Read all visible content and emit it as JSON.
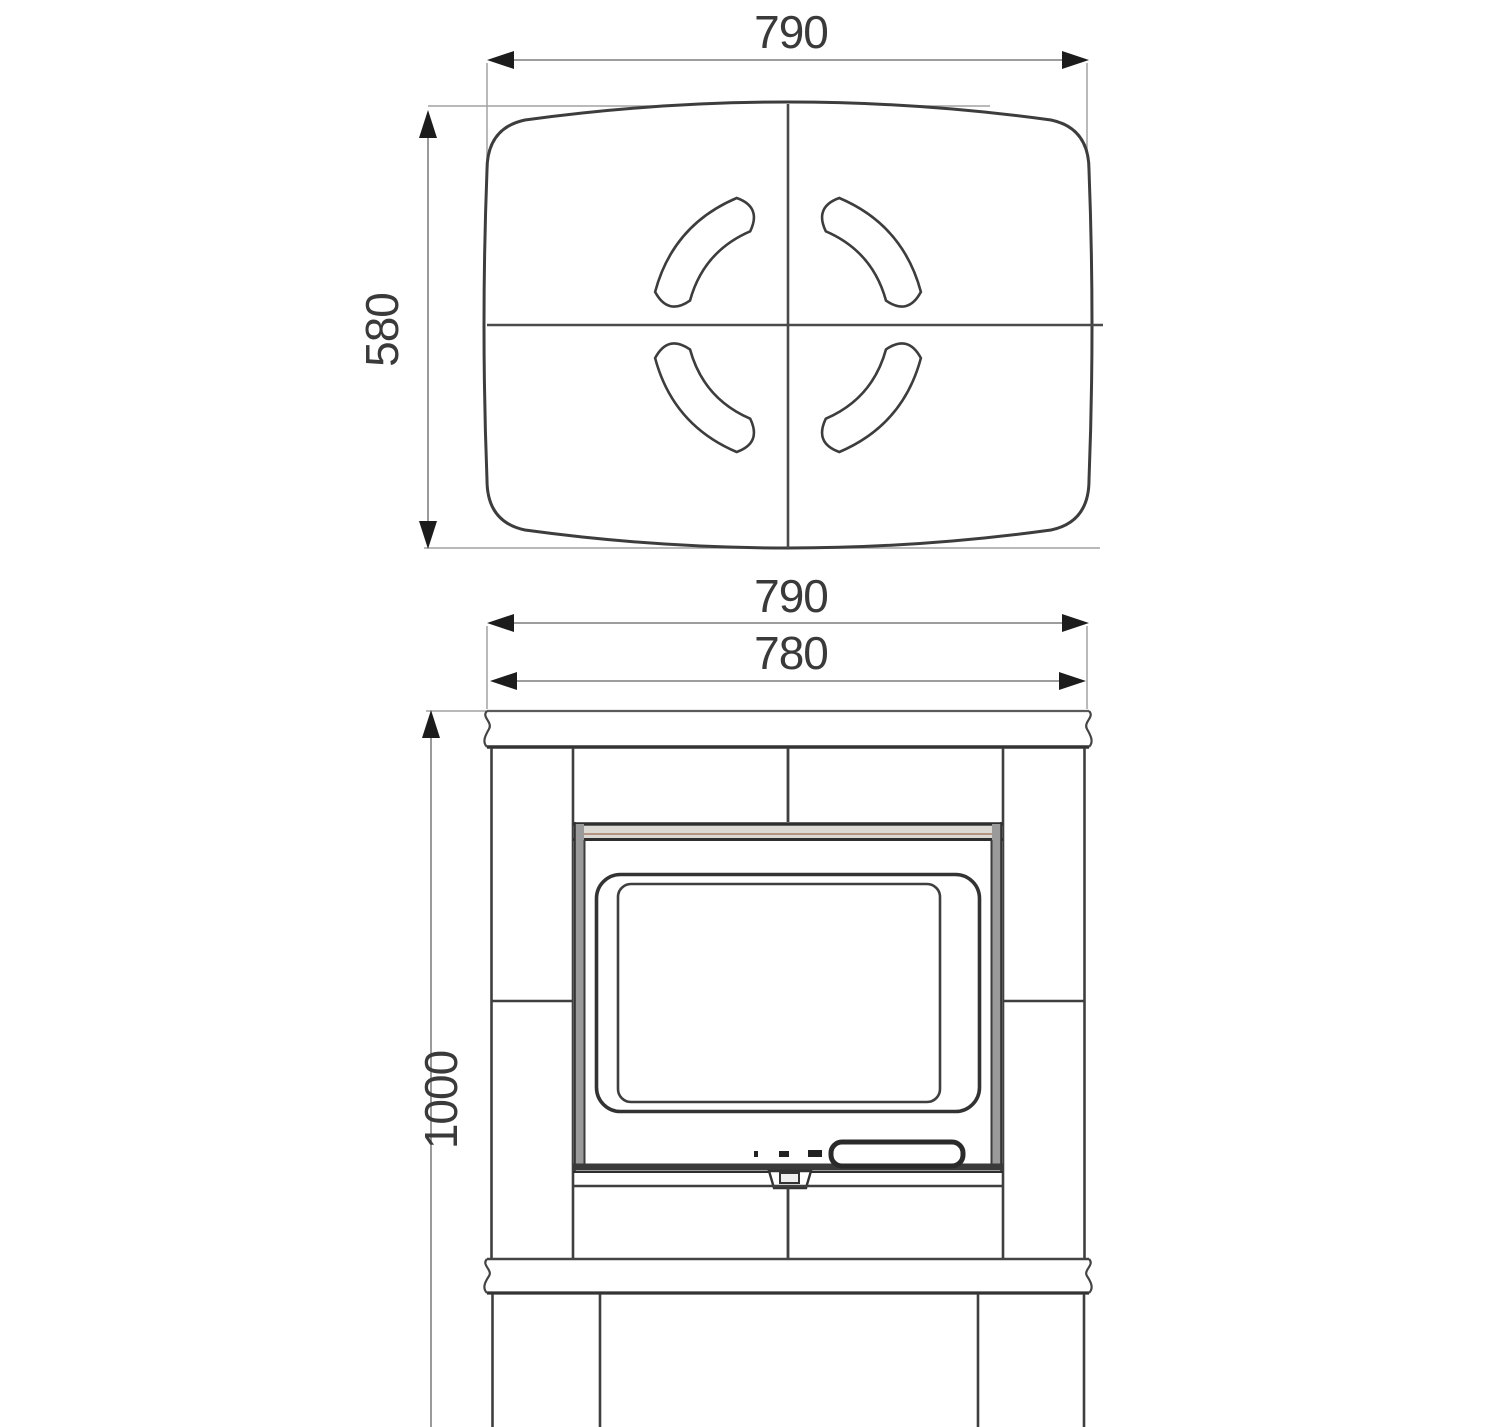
{
  "drawing": {
    "dimensions": {
      "top_width": "790",
      "top_depth": "580",
      "front_top_width": "790",
      "front_body_width": "780",
      "front_height": "1000"
    },
    "colors": {
      "outline": "#3d3d3d",
      "dim_line": "#8f8f8f",
      "arrow": "#1c1c1c",
      "text": "#3a3a3a",
      "door_band_fill": "#dcd9d4",
      "door_band_accent": "#b29480",
      "door_side_fill": "#9a9a9a",
      "background": "#ffffff"
    }
  }
}
